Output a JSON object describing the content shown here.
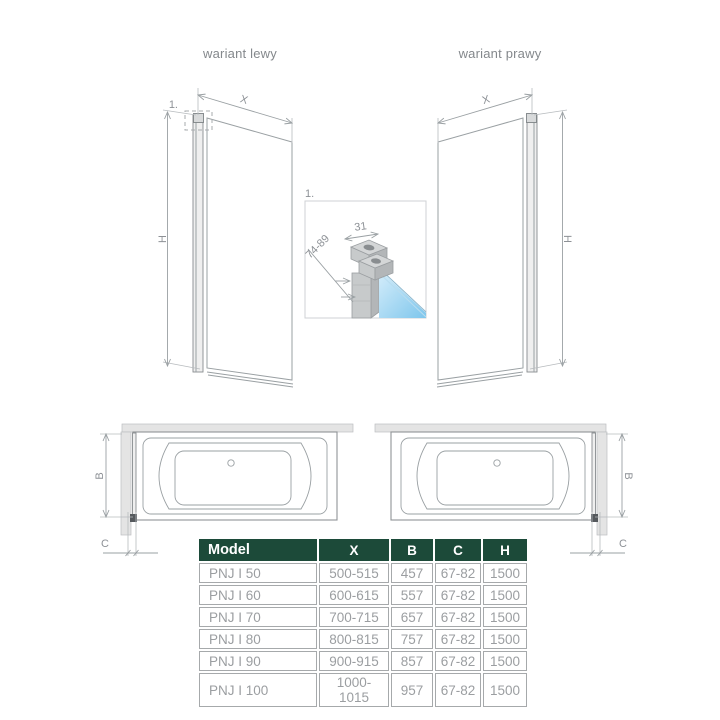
{
  "variants": {
    "left_label": "wariant lewy",
    "right_label": "wariant prawy"
  },
  "dims": {
    "width": "X",
    "height": "H",
    "tub_width": "B",
    "offset": "C"
  },
  "detail": {
    "ref": "1.",
    "top_width": "31",
    "depth_range": "74-89"
  },
  "spec_table": {
    "headers": [
      "Model",
      "X",
      "B",
      "C",
      "H"
    ],
    "rows": [
      [
        "PNJ I 50",
        "500-515",
        "457",
        "67-82",
        "1500"
      ],
      [
        "PNJ I 60",
        "600-615",
        "557",
        "67-82",
        "1500"
      ],
      [
        "PNJ I 70",
        "700-715",
        "657",
        "67-82",
        "1500"
      ],
      [
        "PNJ I 80",
        "800-815",
        "757",
        "67-82",
        "1500"
      ],
      [
        "PNJ I 90",
        "900-915",
        "857",
        "67-82",
        "1500"
      ],
      [
        "PNJ I 100",
        "1000-1015",
        "957",
        "67-82",
        "1500"
      ]
    ]
  },
  "colors": {
    "accent_green": "#1c4a39",
    "line_gray": "#9aa0a3",
    "dim_text_gray": "#8d9196",
    "table_text_gray": "#9b9ea1",
    "wall_fill": "#e4e4e4",
    "glass_blue": "#7ec6ec",
    "glass_blue_light": "#d7eefb"
  }
}
